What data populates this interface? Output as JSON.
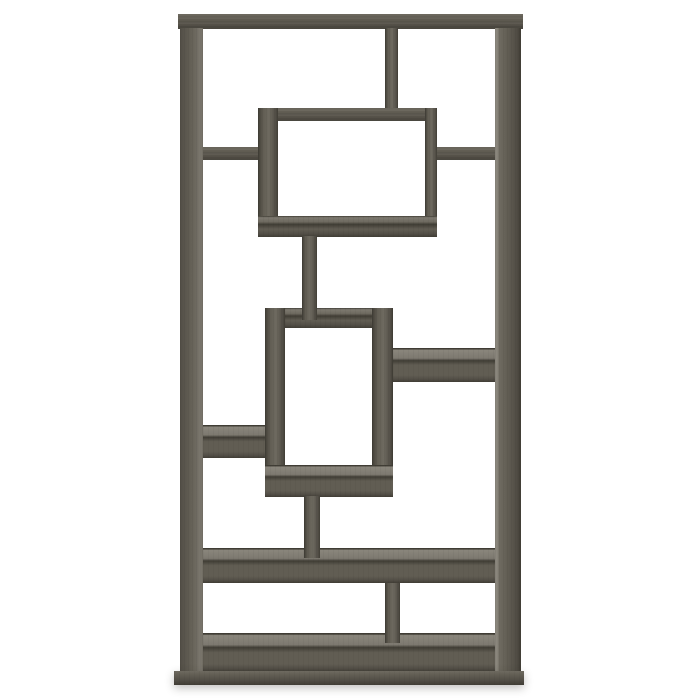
{
  "scene": {
    "background_color": "#ffffff",
    "subject": "Geometric open-back bookcase with interlocking rectangular shelves in weathered grey wood, photographed straight-on against a plain white background"
  },
  "palette": {
    "background": "#ffffff",
    "wood_edge": "#403d35",
    "wood_dark": "#524e46",
    "wood_mid": "#615d53",
    "wood_mid_light": "#6e6a60",
    "wood_light": "#7d7970",
    "wood_lighter": "#8a867c",
    "shadow_color": "rgba(45,42,36,0.30)"
  },
  "bookcase": {
    "frame": {
      "x": 174,
      "y": 14,
      "width": 350,
      "height": 672
    },
    "parts": [
      {
        "name": "top-panel",
        "x": 178,
        "y": 14,
        "w": 345,
        "h": 15,
        "finish": "f-face"
      },
      {
        "name": "left-side-panel",
        "x": 180,
        "y": 28,
        "w": 23,
        "h": 645,
        "finish": "f-vleft"
      },
      {
        "name": "right-side-panel",
        "x": 495,
        "y": 28,
        "w": 26,
        "h": 645,
        "finish": "f-vright"
      },
      {
        "name": "top-divider",
        "x": 385,
        "y": 28,
        "w": 13,
        "h": 82,
        "finish": "f-vmid"
      },
      {
        "name": "upper-left-shelf",
        "x": 203,
        "y": 147,
        "w": 55,
        "h": 13,
        "finish": "f-face"
      },
      {
        "name": "upper-right-shelf",
        "x": 437,
        "y": 147,
        "w": 58,
        "h": 13,
        "finish": "f-face"
      },
      {
        "name": "upper-box-top",
        "x": 258,
        "y": 108,
        "w": 179,
        "h": 13,
        "finish": "f-face"
      },
      {
        "name": "upper-box-left",
        "x": 258,
        "y": 108,
        "w": 20,
        "h": 129,
        "finish": "f-vmid"
      },
      {
        "name": "upper-box-right",
        "x": 425,
        "y": 108,
        "w": 12,
        "h": 129,
        "finish": "f-vmid"
      },
      {
        "name": "upper-box-shelf",
        "x": 258,
        "y": 216,
        "w": 179,
        "h": 21,
        "finish": "f-toplit-thin"
      },
      {
        "name": "lower-box-top",
        "x": 265,
        "y": 308,
        "w": 128,
        "h": 20,
        "finish": "f-toplit-thin"
      },
      {
        "name": "lower-box-left",
        "x": 265,
        "y": 308,
        "w": 20,
        "h": 189,
        "finish": "f-vmid"
      },
      {
        "name": "lower-box-right",
        "x": 372,
        "y": 308,
        "w": 21,
        "h": 189,
        "finish": "f-vmid"
      },
      {
        "name": "lower-box-shelf",
        "x": 265,
        "y": 465,
        "w": 128,
        "h": 32,
        "finish": "f-toplit"
      },
      {
        "name": "center-connector-upper",
        "x": 302,
        "y": 236,
        "w": 15,
        "h": 84,
        "finish": "f-vmid"
      },
      {
        "name": "mid-right-shelf",
        "x": 393,
        "y": 348,
        "w": 102,
        "h": 34,
        "finish": "f-toplit"
      },
      {
        "name": "mid-left-shelf",
        "x": 203,
        "y": 425,
        "w": 62,
        "h": 33,
        "finish": "f-toplit"
      },
      {
        "name": "wide-shelf",
        "x": 203,
        "y": 548,
        "w": 292,
        "h": 35,
        "finish": "f-toplit"
      },
      {
        "name": "center-connector-lower",
        "x": 304,
        "y": 496,
        "w": 16,
        "h": 62,
        "finish": "f-vmid"
      },
      {
        "name": "bottom-shelf",
        "x": 203,
        "y": 633,
        "w": 292,
        "h": 39,
        "finish": "f-toplit"
      },
      {
        "name": "lower-divider",
        "x": 385,
        "y": 583,
        "w": 15,
        "h": 60,
        "finish": "f-vmid"
      },
      {
        "name": "base-plinth",
        "x": 174,
        "y": 671,
        "w": 350,
        "h": 14,
        "finish": "f-plinth f-shadow"
      }
    ]
  }
}
